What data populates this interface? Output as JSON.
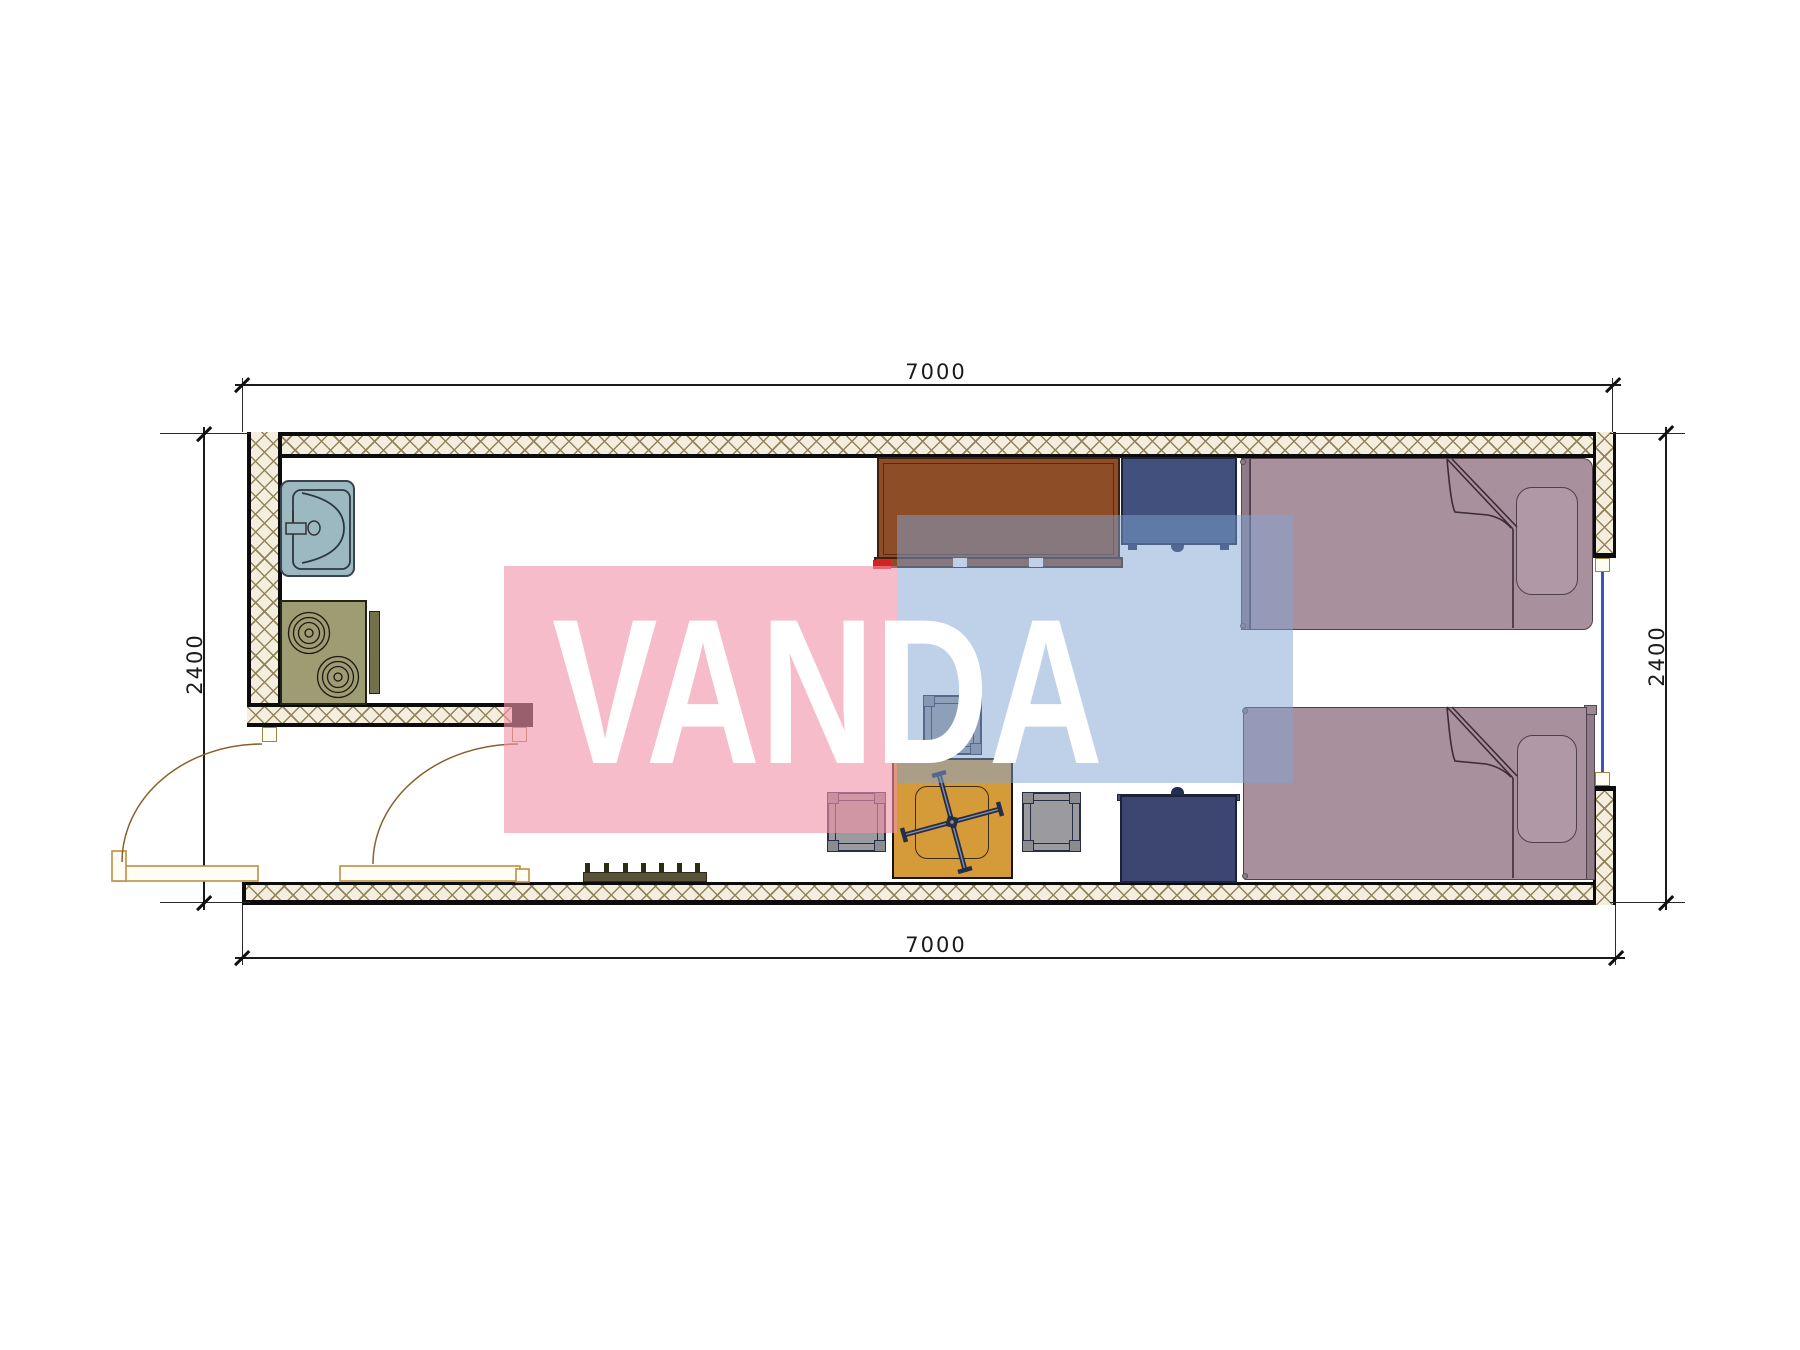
{
  "drawing": {
    "type": "floor-plan",
    "watermark_text": "VANDA"
  },
  "dimensions": {
    "top": "7000",
    "bottom": "7000",
    "left": "2400",
    "right": "2400"
  },
  "colors": {
    "wall-line": "#0c0c0c",
    "hatch-bg": "#f4eede",
    "hatch-line": "#93835b",
    "watermark-pink": "#f093a8",
    "watermark-blue": "#7fa3d4",
    "watermark-text": "#ffffff",
    "bed": "#a9909d",
    "pillow": "#b098a6",
    "desk": "#8c4d27",
    "cabinet": "#41507c",
    "dresser": "#3d4670",
    "table": "#d59b39",
    "stool": "#9b9b9f",
    "stool-border": "#262e46",
    "sink": "#9cb9c2",
    "stove": "#9d9c72",
    "door": "#bd8f44",
    "glazing": "#3f51c2",
    "dim": "#1a1a1a",
    "accent-red": "#d22222"
  }
}
